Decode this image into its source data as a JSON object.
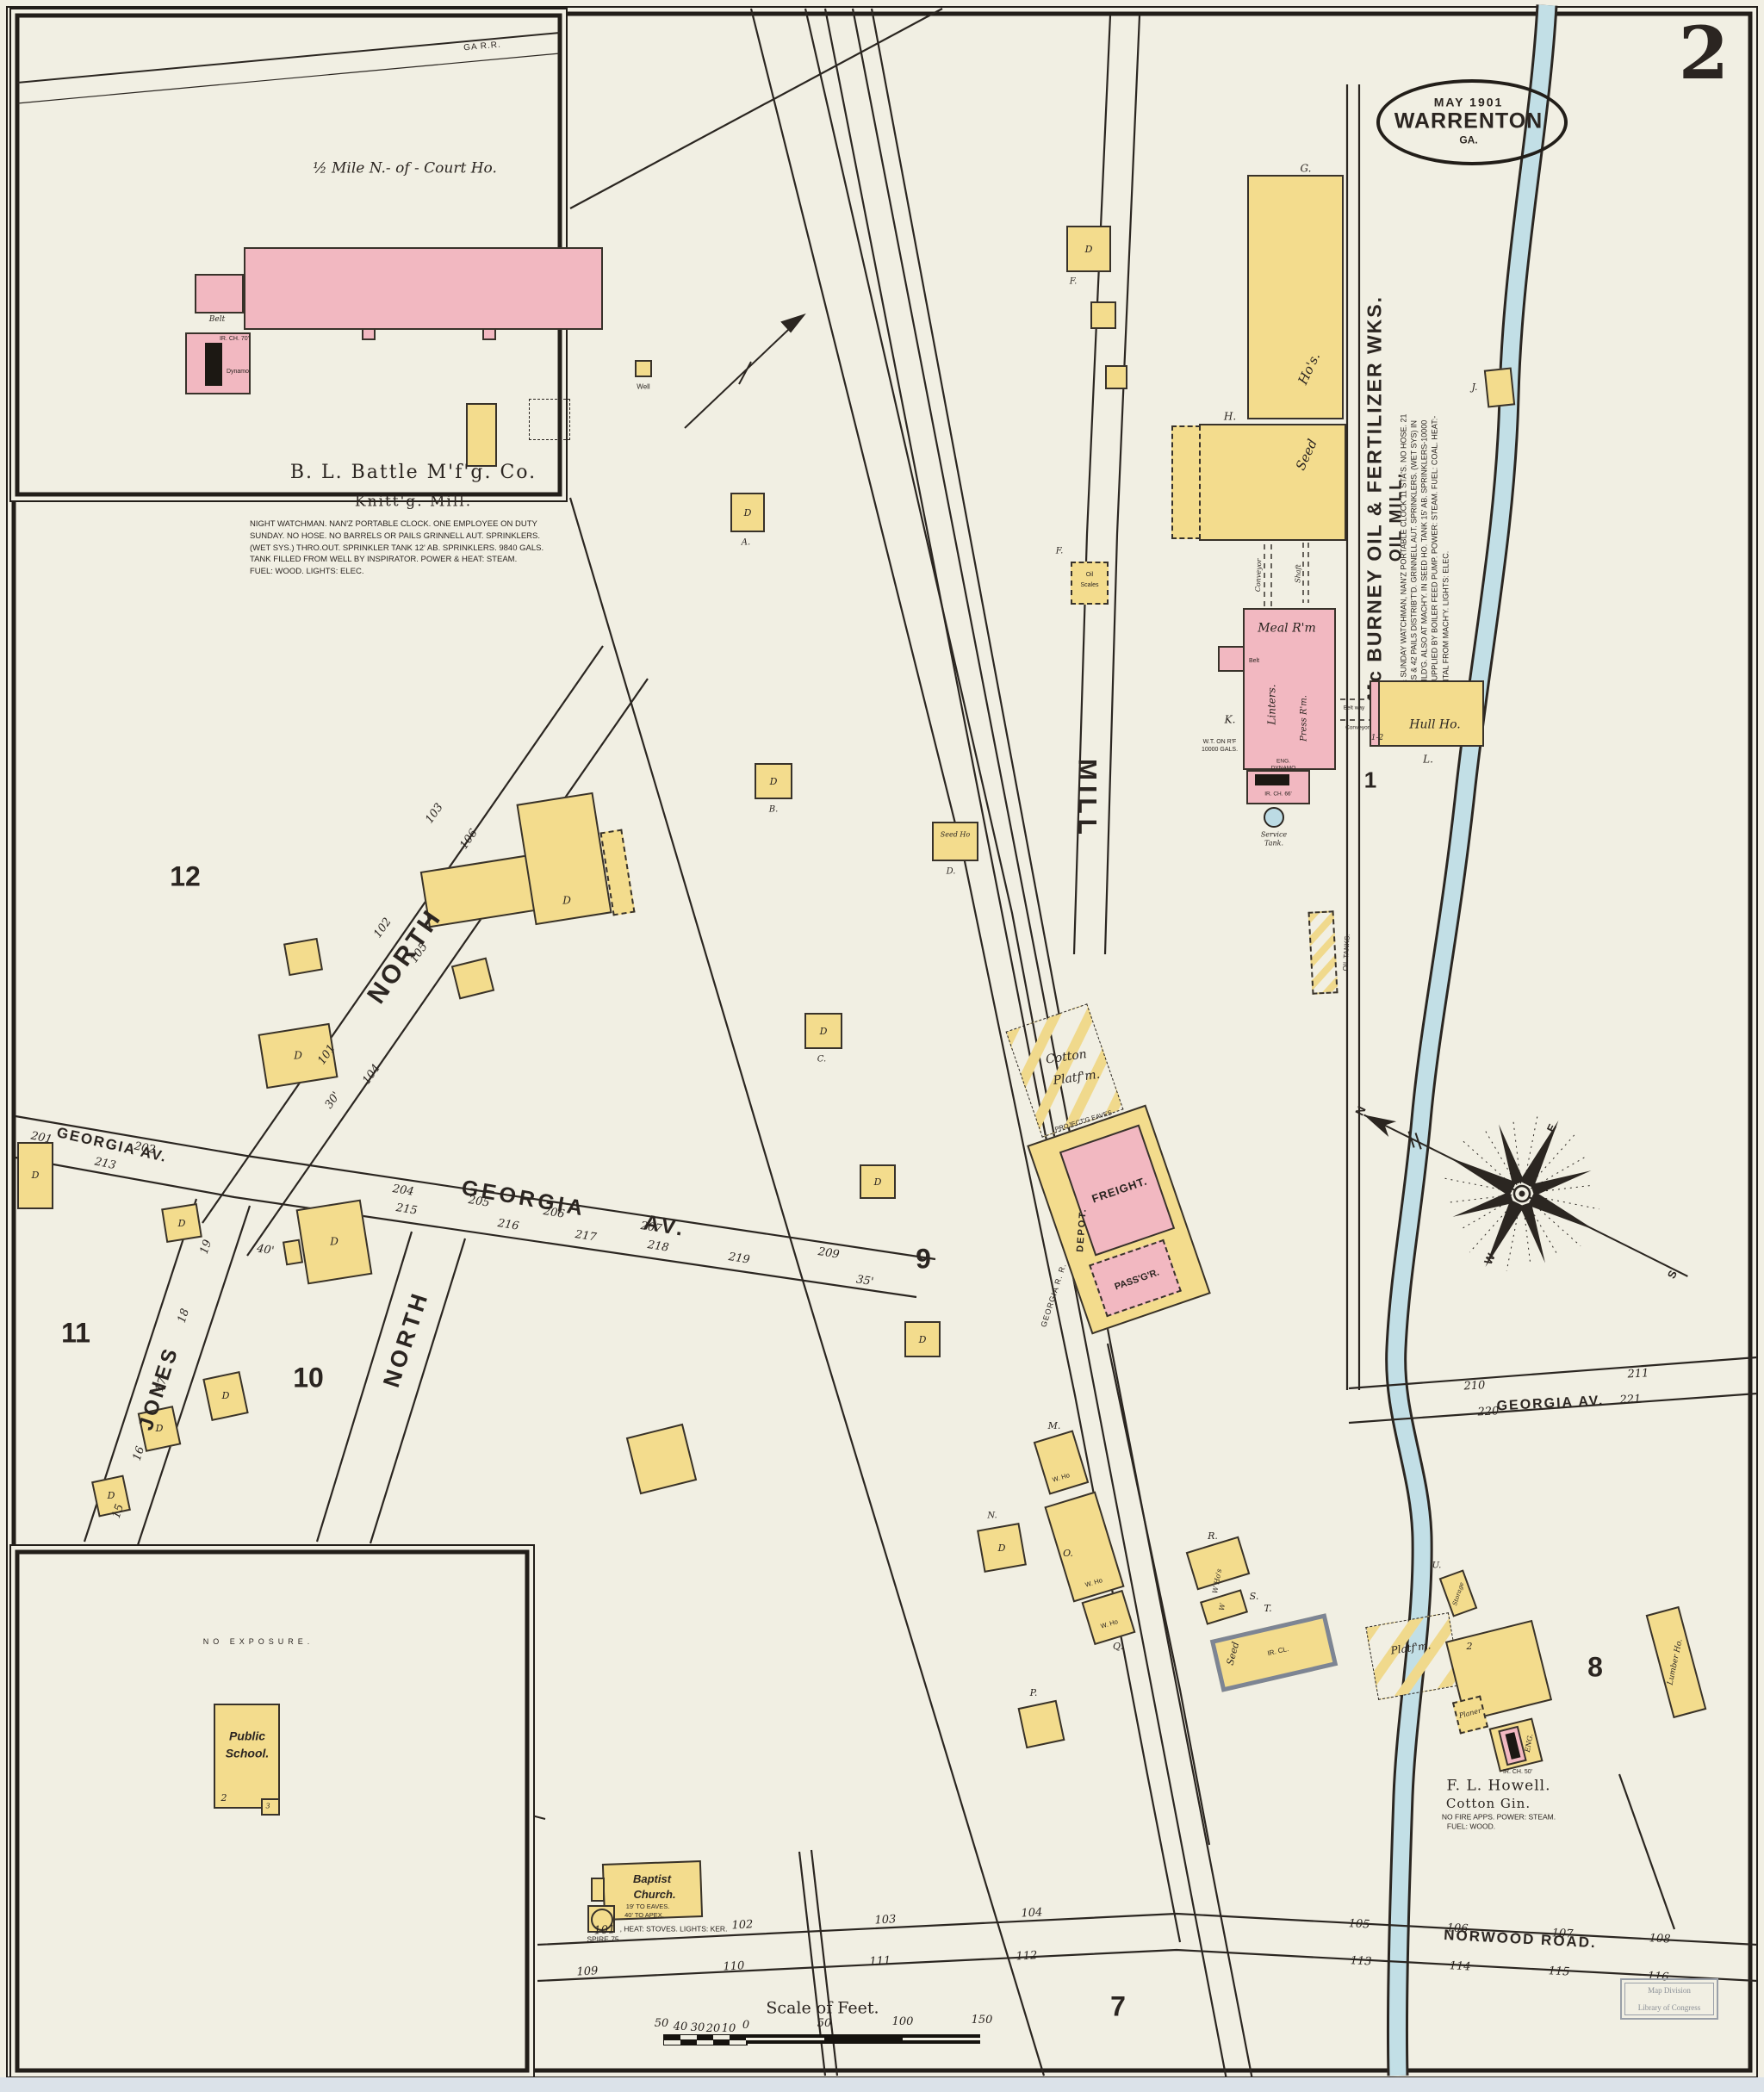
{
  "page": {
    "sheet_number": "2",
    "stamp": {
      "date": "MAY 1901",
      "city": "WARRENTON",
      "state": "GA."
    },
    "scale": {
      "title": "Scale of Feet.",
      "ticks": [
        "50",
        "40",
        "30",
        "20",
        "10",
        "0",
        "50",
        "100",
        "150"
      ]
    },
    "library_stamp": {
      "line1": "Map Division",
      "line2": "Library of Congress"
    }
  },
  "streets": {
    "north_upper": "NORTH",
    "north_lower": "NORTH",
    "jones": "JONES",
    "mill": "MILL",
    "georgia_av_left": "GEORGIA AV.",
    "georgia_mid_1": "GEORGIA",
    "georgia_mid_2": "AV.",
    "georgia_av_right": "GEORGIA AV.",
    "norwood": "NORWOOD ROAD.",
    "ga_rr": "GA R.R.",
    "georgia_rr": "GEORGIA R. R."
  },
  "blocks": {
    "b1": "1",
    "b7": "7",
    "b8": "8",
    "b9": "9",
    "b10": "10",
    "b11": "11",
    "b12": "12"
  },
  "compass": {
    "n": "N",
    "e": "E",
    "s": "S",
    "w": "W"
  },
  "battle_inset": {
    "distance_note": "½ Mile N.- of - Court Ho.",
    "company": "B. L. Battle M'f'g. Co.",
    "business": "Knitt'g. Mill.",
    "details": [
      "NIGHT WATCHMAN. NAN'Z PORTABLE CLOCK. ONE EMPLOYEE ON DUTY",
      "SUNDAY. NO HOSE. NO BARRELS OR PAILS GRINNELL AUT. SPRINKLERS.",
      "(WET SYS.) THRO.OUT. SPRINKLER TANK 12' AB. SPRINKLERS. 9840 GALS.",
      "TANK FILLED FROM WELL BY INSPIRATOR. POWER & HEAT: STEAM.",
      "FUEL: WOOD. LIGHTS: ELEC."
    ],
    "ir_ch_70": "IR. CH. 70'",
    "dynamo": "Dynamo",
    "belt": "Belt",
    "well": "Well"
  },
  "school_inset": {
    "no_exposure": "NO EXPOSURE.",
    "school_line1": "Public",
    "school_line2": "School.",
    "school_num": "2",
    "school_annex": "3",
    "church_line1": "Baptist",
    "church_line2": "Church.",
    "church_eaves": "19' TO EAVES.",
    "church_apex": "40' TO APEX.",
    "church_heat": ", HEAT: STOVES. LIGHTS: KER.",
    "church_spire": "SPIRE 75"
  },
  "oil_mill": {
    "company": "Mc BURNEY OIL & FERTILIZER WKS.",
    "business": "OIL MILL.",
    "details": [
      "NIGHT & SUNDAY WATCHMAN, NAN'Z PORTABLE CLOCK 11 STA'S. NO HOSE. 21",
      "BARRELS & 42 PAILS DISTRIB'T'D. GRINNELL AUT. SPRINKLERS. (WET SYS) IN",
      "MILL BUILD'G. ALSO AT MACH'Y. IN SEED HO. TANK 15' AB. SPRINKLERS-10000",
      "GALS. SUPPLIED BY BOILER FEED PUMP. POWER: STEAM. FUEL: COAL. HEAT:-",
      "INCIDENTAL FROM MACH'Y. LIGHTS: ELEC."
    ],
    "seed": "Seed",
    "hos": "Ho's.",
    "meal_rm": "Meal R'm",
    "linters": "Linters.",
    "press_rm": "Press R'm.",
    "belt": "Belt",
    "belt_way": "Belt way",
    "conveyor": "Conveyor",
    "shaft": "Shaft",
    "hull_ho": "Hull Ho.",
    "one_two": "1-2",
    "wt1": "W.T. ON R'F",
    "wt2": "10000 GALS.",
    "eng": "ENG.",
    "dynamo": "DYNAMO",
    "ir_ch_66": "IR. CH. 66'",
    "service1": "Service",
    "service2": "Tank.",
    "oil_tanks": "OIL TANKS.",
    "scales1": "Oil",
    "scales2": "Scales",
    "g": "G.",
    "h": "H.",
    "j": "J.",
    "k": "K.",
    "l": "L."
  },
  "depot": {
    "cotton1": "Cotton",
    "cotton2": "Platf'm.",
    "eaves": "PROJECT'G EAVES",
    "freight": "FREIGHT.",
    "passenger": "PASS'G'R.",
    "name": "DEPOT."
  },
  "howell": {
    "owner": "F. L. Howell.",
    "business": "Cotton Gin.",
    "detail1": "NO FIRE APPS. POWER: STEAM.",
    "detail2": "FUEL: WOOD.",
    "platform": "Platf'm.",
    "planer": "Planer",
    "eng": "ENG.",
    "ir_ch_50": "IR. CH. 50'",
    "num": "2",
    "storage": "Storage",
    "u": "U.",
    "lumber": "Lumber Ho."
  },
  "warehouses": {
    "m": "M.",
    "n": "N.",
    "o": "O.",
    "p": "P.",
    "q": "Q.",
    "r": "R.",
    "s": "S.",
    "t": "T.",
    "w_ho": "W. Ho",
    "w_hos": "W Ho's",
    "w": "W",
    "ir_cl": "IR. CL.",
    "seed": "Seed",
    "seed_ho": "Seed Ho"
  },
  "dwellings": {
    "d": "D",
    "a": "A.",
    "b": "B.",
    "c": "C.",
    "d_dot": "D.",
    "f": "F."
  },
  "numbers": {
    "101": "101",
    "102": "102",
    "103": "103",
    "104": "104",
    "105": "105",
    "106": "106",
    "107": "107",
    "108": "108",
    "109": "109",
    "110": "110",
    "111": "111",
    "112": "112",
    "113": "113",
    "114": "114",
    "115": "115",
    "116": "116",
    "201": "201",
    "202": "202",
    "204": "204",
    "205": "205",
    "206": "206",
    "207": "207",
    "209": "209",
    "210": "210",
    "211": "211",
    "213": "213",
    "215": "215",
    "216": "216",
    "217": "217",
    "218": "218",
    "219": "219",
    "220": "220",
    "221": "221",
    "15": "15",
    "16": "16",
    "17": "17",
    "18": "18",
    "19": "19",
    "ft30": "30'",
    "ft35": "35'",
    "ft40": "40'"
  }
}
